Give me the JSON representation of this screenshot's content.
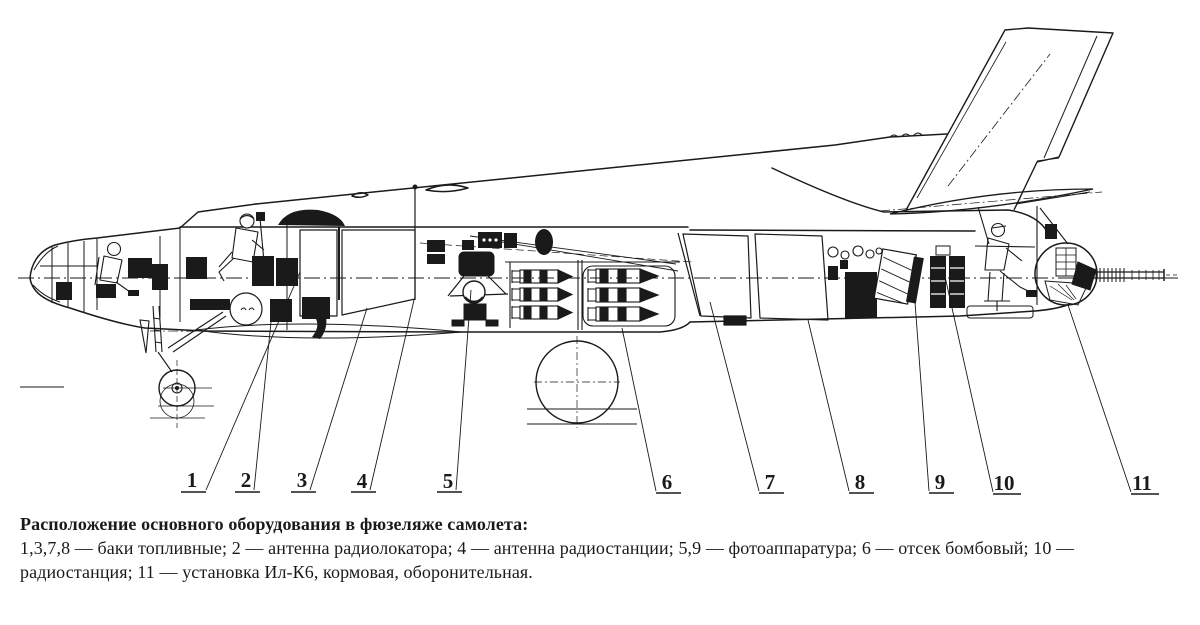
{
  "figure": {
    "type": "technical-cutaway-diagram",
    "subject": "Il-28 bomber fuselage equipment layout (side-view cutaway)",
    "colors": {
      "ink": "#1a1a1a",
      "paper": "#ffffff"
    },
    "caption": {
      "title": "Расположение основного оборудования в фюзеляже самолета:",
      "line2": "1,3,7,8 — баки топливные; 2 — антенна радиолокатора; 4 — антенна радиостанции; 5,9 — фотоаппаратура; 6 — отсек бомбовый; 10 —",
      "line3": "радиостанция; 11 — установка Ил-К6, кормовая, оборонительная."
    },
    "legend": [
      {
        "keys": "1,3,7,8",
        "label": "баки топливные"
      },
      {
        "keys": "2",
        "label": "антенна радиолокатора"
      },
      {
        "keys": "4",
        "label": "антенна радиостанции"
      },
      {
        "keys": "5,9",
        "label": "фотоаппаратура"
      },
      {
        "keys": "6",
        "label": "отсек бомбовый"
      },
      {
        "keys": "10",
        "label": "радиостанция"
      },
      {
        "keys": "11",
        "label": "установка Ил-К6, кормовая, оборонительная"
      }
    ],
    "callouts": [
      "1",
      "2",
      "3",
      "4",
      "5",
      "6",
      "7",
      "8",
      "9",
      "10",
      "11"
    ]
  }
}
